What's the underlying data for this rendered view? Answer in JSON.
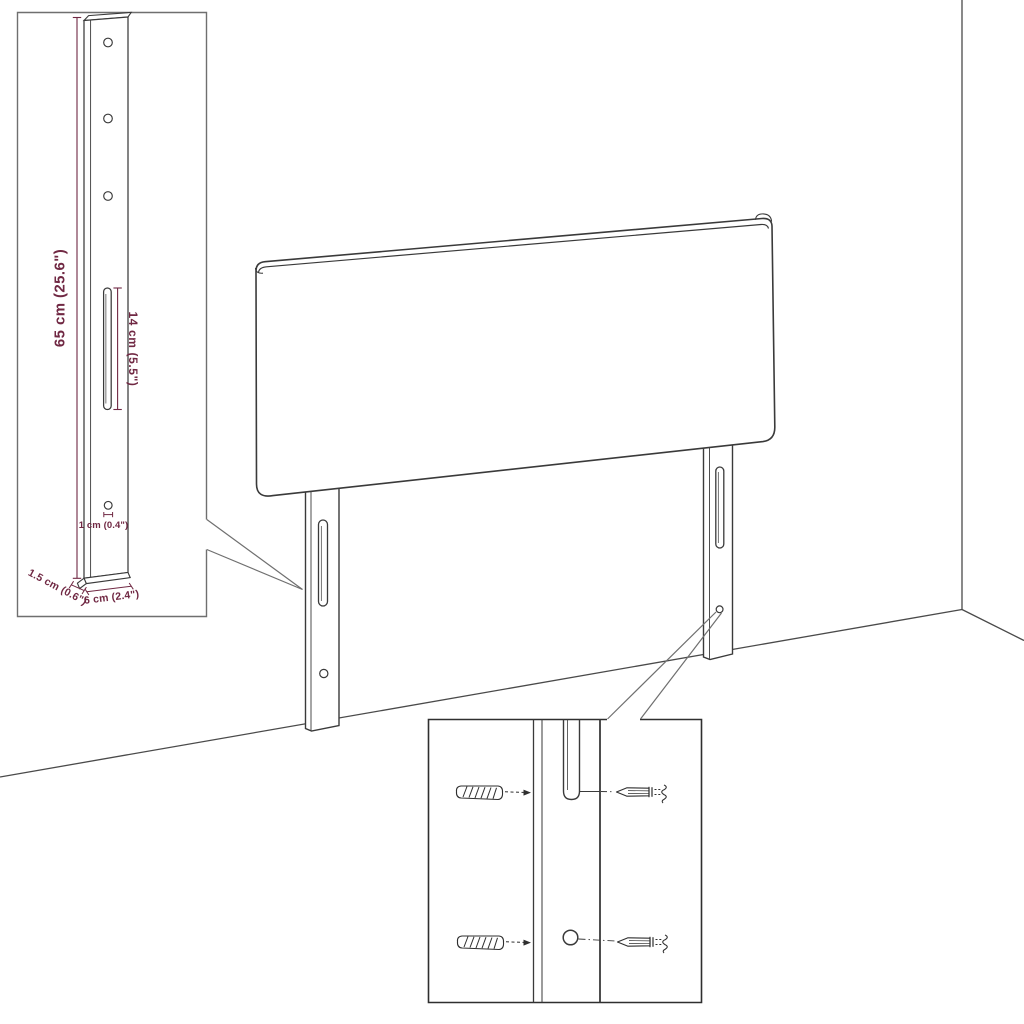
{
  "drawing": {
    "title_hint": "headboard-assembly-diagram",
    "inset_detail": {
      "dim_height": "65 cm (25.6\")",
      "dim_slot": "14 cm (5.5\")",
      "dim_hole": "1 cm (0.4\")",
      "dim_depth": "1.5 cm (0.6\")",
      "dim_width": "6 cm (2.4\")"
    }
  },
  "colors": {
    "dimension": "#702843",
    "line": "#3a3a3a",
    "box_border": "#6f6f6f",
    "detail_box_border": "#2f2f2f"
  }
}
